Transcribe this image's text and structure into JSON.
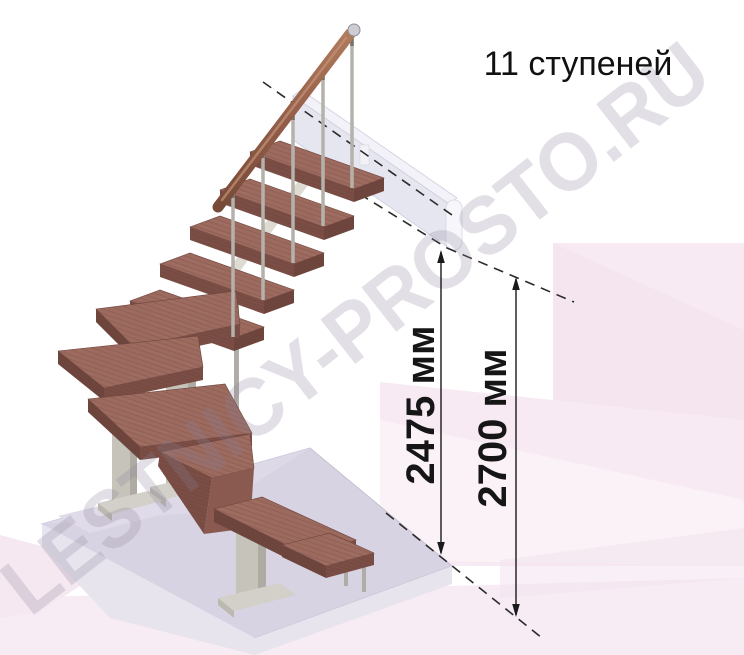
{
  "title": {
    "text": "11 ступеней"
  },
  "annotations": {
    "dimension_1": "2475 мм",
    "dimension_2": "2700 мм"
  },
  "watermark": {
    "text": "LESTNICY-PROSTO.RU"
  },
  "colors": {
    "tread_top": "#9c6a5f",
    "tread_front": "#7b4e45",
    "tread_side": "#6e453d",
    "handrail": "#96604a",
    "metal_column": "#c6c3bb",
    "baluster": "#b5b2ab",
    "floor_slab_top": "#d8d3e2",
    "floor_slab_front": "#e8e4ee",
    "upper_landing": "#e6e6f0",
    "background_accent": "#f8eaf2",
    "annotation_ink": "#1a1a1a",
    "watermark_gray": "#8a8299"
  }
}
